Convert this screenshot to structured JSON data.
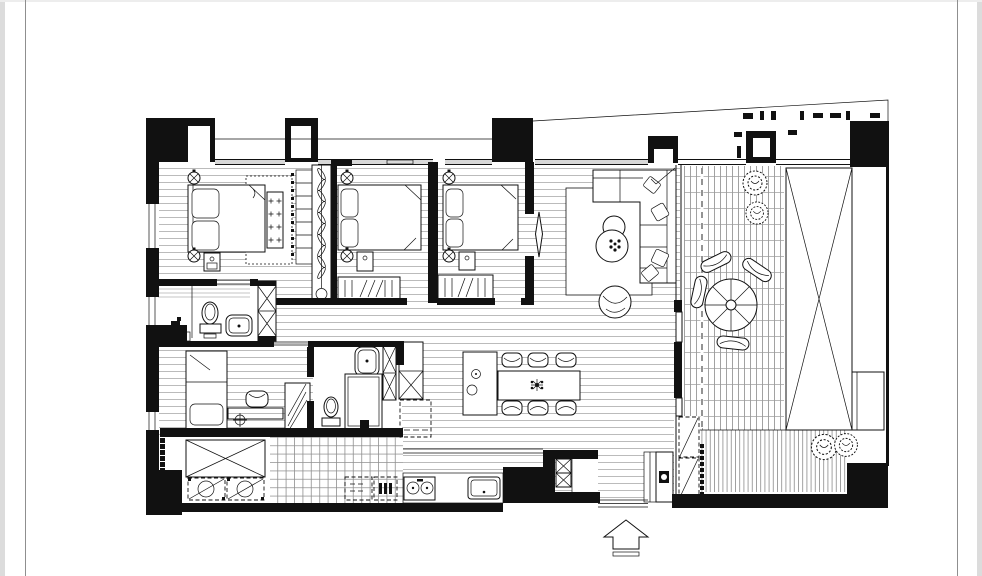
{
  "palette": {
    "ink": "#111111",
    "paper": "#ffffff",
    "floorline": "#b3b3b3",
    "glass": "#d8d8d8",
    "pageline": "#8f8f8f",
    "pageedge": "#dcdcdc"
  },
  "page": {
    "background": "#ffffff",
    "left_border_x": 25,
    "right_border_x": 957,
    "content": "black-and-white architectural floor plan, no text labels"
  },
  "drawing": {
    "type": "apartment floor plan, CAD-style ink line drawing",
    "entrance_arrow": "hollow up-pointing arrow centered below the bottom wall",
    "counts": {
      "bedrooms": 3,
      "bathrooms": 2,
      "dining_chairs": 6,
      "terrace_chairs": 4,
      "plants": 4,
      "laundry_machines": 2,
      "cooktop_burners": 2
    },
    "rooms": [
      {
        "id": "master-bedroom",
        "position": "top-left",
        "furniture": [
          "double-bed",
          "two-pillows",
          "tufted-bench",
          "dashed-area-rug",
          "shelved-closet",
          "nightstand",
          "two-ceiling-symbols"
        ]
      },
      {
        "id": "bedroom-2",
        "position": "top-center-left",
        "furniture": [
          "double-bed",
          "two-pillows",
          "hanger-wardrobe",
          "nightstand",
          "two-ceiling-symbols"
        ]
      },
      {
        "id": "bedroom-3",
        "position": "top-center",
        "furniture": [
          "double-bed",
          "two-pillows",
          "hanger-wardrobe",
          "nightstand",
          "sliding-door-leaf",
          "two-ceiling-symbols"
        ]
      },
      {
        "id": "hanging-closet-strip",
        "position": "between master-bedroom and bedroom-2",
        "furniture": [
          "clothes-rail-with-hangers"
        ]
      },
      {
        "id": "living-room",
        "position": "top-right of interior",
        "furniture": [
          "l-shaped-sofa",
          "throw-pillows",
          "two-round-coffee-tables",
          "round-lounge-chair",
          "area-rug",
          "terrace-door-swing"
        ]
      },
      {
        "id": "dining-area",
        "position": "center",
        "furniture": [
          "rectangular-table",
          "six-chairs",
          "centerpiece",
          "kitchen-island-with-sink"
        ]
      },
      {
        "id": "kitchen",
        "position": "bottom-center",
        "furniture": [
          "counter",
          "two-burner-cooktop",
          "sink",
          "two-dashed-appliances",
          "tall-cabinet-x",
          "dashed-refrigerator"
        ]
      },
      {
        "id": "bathroom-1",
        "position": "left, en-suite",
        "furniture": [
          "toilet",
          "washbasin",
          "shower-corner",
          "linen-cabinet-x",
          "shelves"
        ]
      },
      {
        "id": "bathroom-2",
        "position": "center-left",
        "furniture": [
          "toilet",
          "washbasin",
          "shower-stall",
          "storage-cabinet-x"
        ]
      },
      {
        "id": "study-bedroom",
        "position": "bottom-left",
        "furniture": [
          "single-bed",
          "desk",
          "chair",
          "wardrobe",
          "crosshair-symbol"
        ]
      },
      {
        "id": "utility-laundry",
        "position": "bottom-left corner",
        "furniture": [
          "storage-platform-x",
          "washer",
          "dryer",
          "tiled-floor"
        ]
      },
      {
        "id": "entry",
        "position": "bottom center-right",
        "furniture": [
          "entry-door-leaf-with-lock",
          "shaft-boxes-x",
          "threshold-steps",
          "closet"
        ]
      },
      {
        "id": "terrace",
        "position": "right side",
        "furniture": [
          "decking",
          "outdoor-round-table",
          "four-outdoor-chairs",
          "four-planters",
          "long-skylight-frame-x",
          "dashed-expansion-joint",
          "two-dashed-ac-units"
        ]
      }
    ]
  }
}
